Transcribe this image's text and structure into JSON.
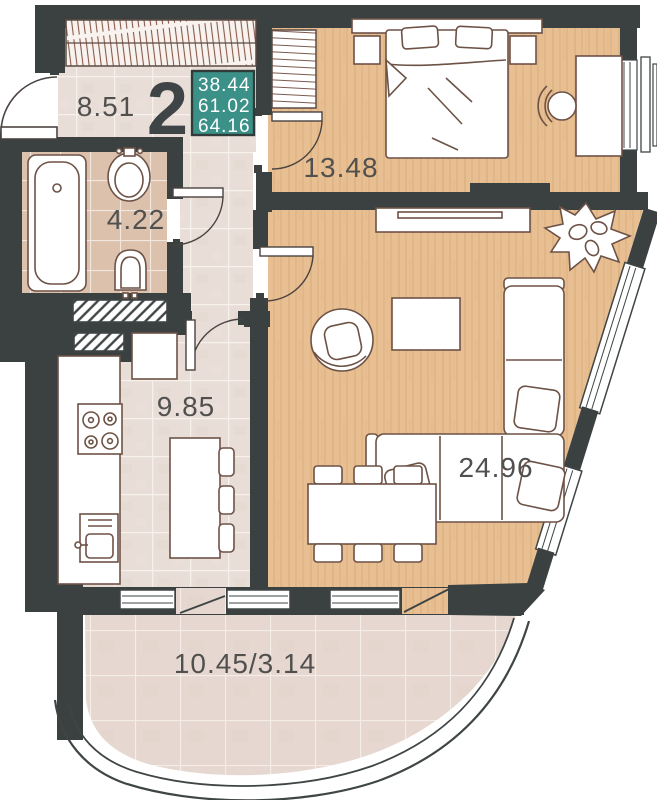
{
  "unit": {
    "rooms_count": "2",
    "areas": {
      "living": "38.44",
      "apartment": "61.02",
      "total": "64.16"
    }
  },
  "rooms": {
    "hallway": "8.51",
    "bathroom": "4.22",
    "kitchen": "9.85",
    "bedroom": "13.48",
    "living_room": "24.96",
    "balcony": "10.45/3.14"
  },
  "colors": {
    "wall": "#3b4141",
    "accent_teal": "#3b9188",
    "wood_floor": "#e8bf92",
    "tile_floor": "#e9ded7",
    "bathroom_tile": "#dcc1ac",
    "balcony_tile": "#e6d8d0",
    "furniture_outline": "#6d5246",
    "label_text": "#51504e"
  }
}
